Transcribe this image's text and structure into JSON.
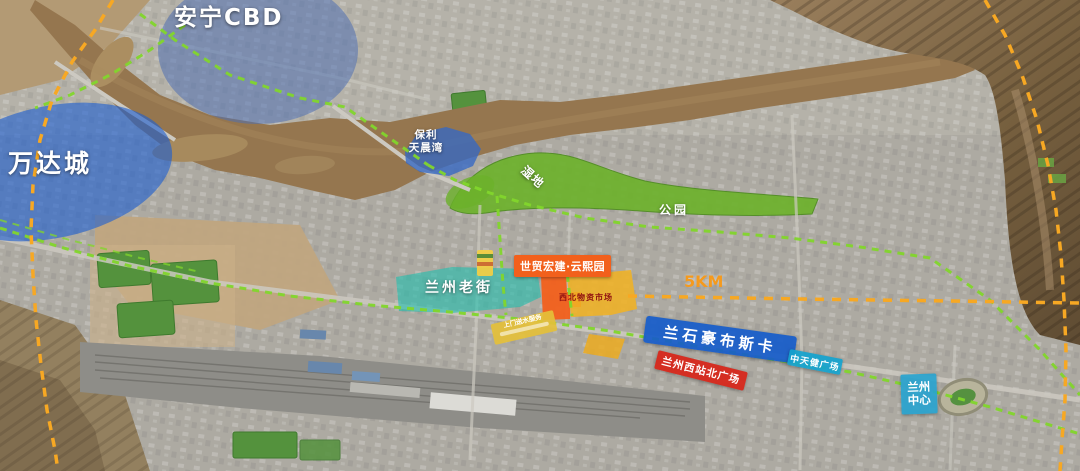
{
  "map": {
    "zones": {
      "anning_cbd": {
        "label": "安宁CBD"
      },
      "wanda_city": {
        "label": "万达城"
      },
      "poly_tianchenwan": {
        "label_line1": "保利",
        "label_line2": "天晨湾"
      },
      "old_street": {
        "label": "兰州老街"
      },
      "project": {
        "label": "世贸宏建·云熙园"
      },
      "nw_materials_market": {
        "label": "西北物资市场"
      },
      "hopsca": {
        "label": "兰石豪布斯卡"
      },
      "west_station_north_plaza": {
        "label": "兰州西站北广场"
      },
      "zhongtianjian_plaza": {
        "label": "中天健广场"
      },
      "lanzhou_center": {
        "label_line1": "兰州",
        "label_line2": "中心"
      }
    },
    "annotations": {
      "wetland": "湿地",
      "park": "公园",
      "distance": "5KM",
      "street_ad": "上门送水服务"
    },
    "colors": {
      "zone_blue": "#4e70b2",
      "zone_blue_strong": "#1e60d0",
      "poly_blue": "#3468c4",
      "zone_teal": "#20beae",
      "project_orange": "#f2601c",
      "market_yellow": "#f0b224",
      "band_blue": "#175cc9",
      "band_red": "#d6271b",
      "band_cyan": "#14a2cd",
      "center_blue": "#28a3ce",
      "route_green": "#82d62c",
      "boundary_orange": "#f7a823",
      "park_green": "#6cb22a",
      "river_brown": "#95764f"
    }
  }
}
